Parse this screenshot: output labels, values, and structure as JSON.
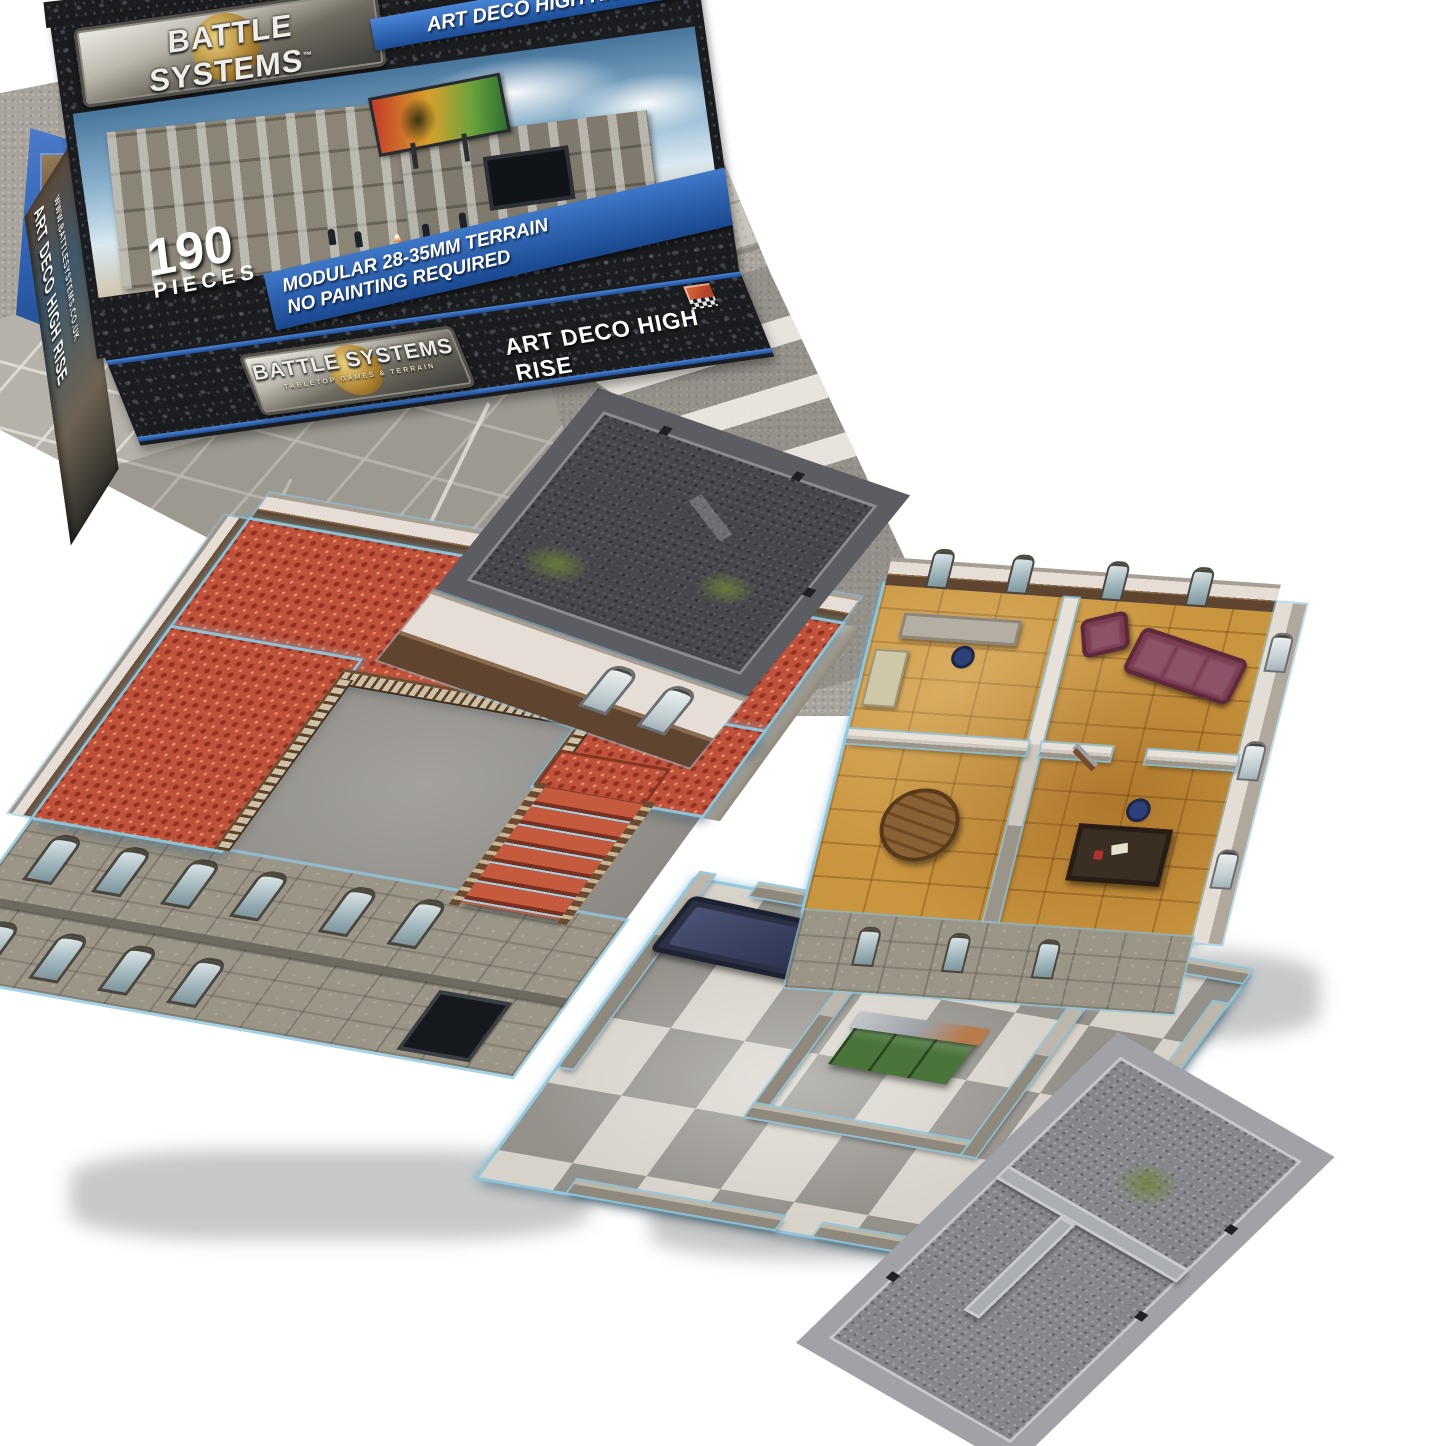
{
  "product": {
    "brand": "BATTLE SYSTEMS",
    "trademark": "™",
    "tagline": "TABLETOP GAMES & TERRAIN",
    "title": "ART DECO HIGH RISE",
    "pieces_count": "190",
    "pieces_label": "PIECES",
    "features": [
      "MODULAR 28-35MM TERRAIN",
      "NO PAINTING REQUIRED"
    ],
    "website": "WWW.BATTLESYSTEMS.CO.UK"
  },
  "colors": {
    "box_granite": "#1b1c1f",
    "banner_blue": "#2f66b5",
    "carpet_red": "#c0513a",
    "parquet_wood": "#c9953f",
    "roof_dark_gravel": "#46474c",
    "roof_light_gravel": "#85878c",
    "checker_dark": "#94918b",
    "checker_light": "#d7d3cb",
    "card_edge_blue": "#8ec7de",
    "sofa_maroon": "#7d3b52",
    "cabinet_green": "#4a7439",
    "street_asphalt": "#a8a49d"
  }
}
